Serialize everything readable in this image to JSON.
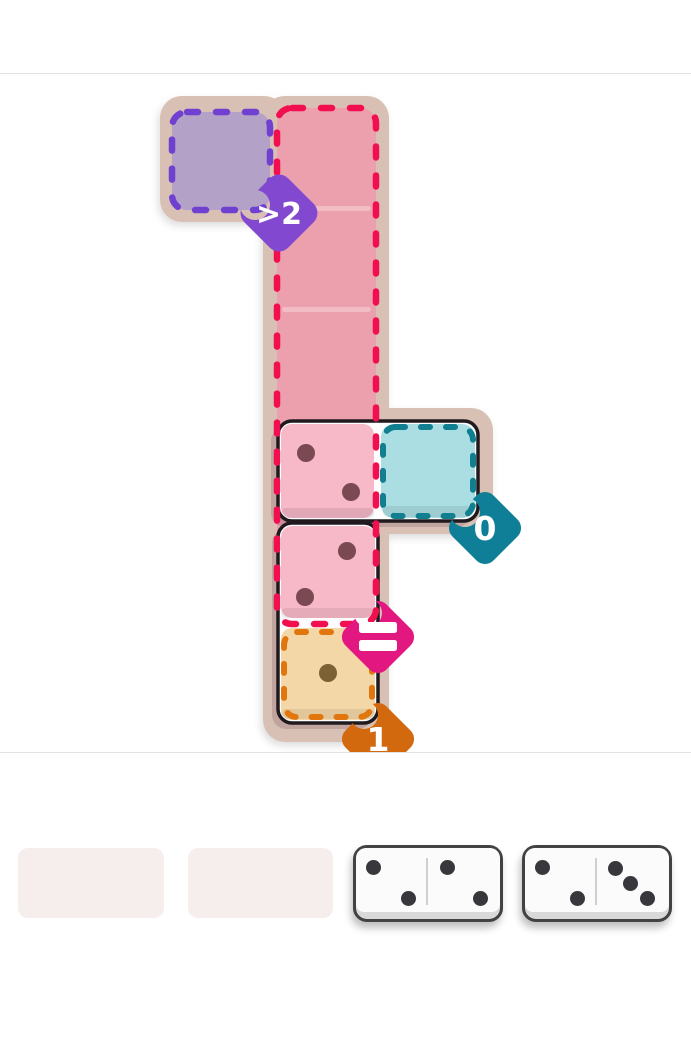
{
  "app": {
    "background_color": "#ffffff",
    "divider_color": "#e4e1e1"
  },
  "board": {
    "frame_color": "#d8c1b4",
    "zones": [
      {
        "id": "purple-zone",
        "label": ">2",
        "badge_color": "#8248d0",
        "dash_color": "#7040d0",
        "fill_color": "#b3a1c7",
        "size_cells": 1
      },
      {
        "id": "red-zone",
        "label": "=",
        "badge_color": "#e2177f",
        "dash_color": "#f10f50",
        "fill_color": "#ec9fad",
        "size_cells": 5
      },
      {
        "id": "teal-zone",
        "label": "0",
        "badge_color": "#0e7f97",
        "dash_color": "#117f90",
        "fill_color": "#abdee3",
        "size_cells": 1
      },
      {
        "id": "orange-zone",
        "label": "1",
        "badge_color": "#d2690f",
        "dash_color": "#e0760d",
        "fill_color": "#f4d7a6",
        "size_cells": 1
      }
    ],
    "placed_dominoes": [
      {
        "orientation": "horizontal",
        "halves": [
          {
            "value": 2
          },
          {
            "value": 0
          }
        ]
      },
      {
        "orientation": "vertical",
        "halves": [
          {
            "value": 2
          },
          {
            "value": 1
          }
        ]
      }
    ],
    "pip_color_pink_cells": "#7a4952",
    "pip_color_tan_cell": "#7c6134"
  },
  "tray": {
    "empty_slot_count": 2,
    "slot_color": "#f6eeed",
    "dominoes": [
      {
        "halves": [
          {
            "value": 2
          },
          {
            "value": 2
          }
        ]
      },
      {
        "halves": [
          {
            "value": 2
          },
          {
            "value": 3
          }
        ]
      }
    ],
    "pip_color": "#38383c"
  }
}
